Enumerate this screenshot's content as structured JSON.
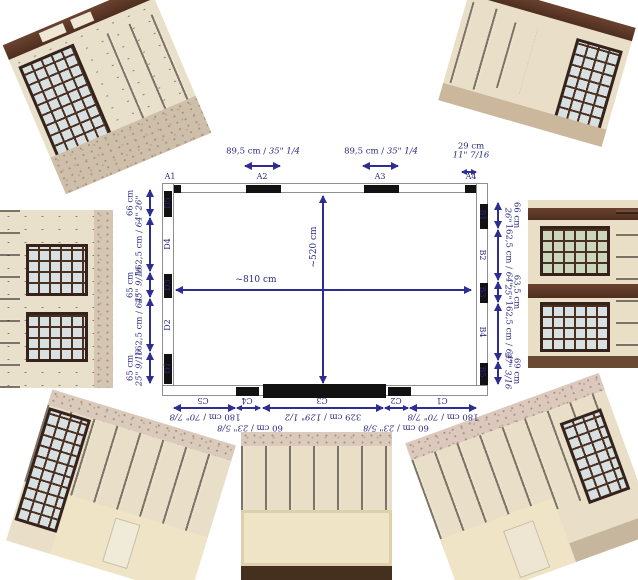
{
  "colors": {
    "annotation_navy": "#2d2d92",
    "wall_black": "#121212",
    "wall_outline_gray": "#8f8f8f",
    "wood_brown": "#5d3a28",
    "cream_wall": "#e9dfc8"
  },
  "plan": {
    "overall": {
      "width_label": "~810 cm",
      "height_label": "~520 cm"
    },
    "top_wall": {
      "labels": [
        "A1",
        "A2",
        "A3",
        "A4"
      ],
      "measures": [
        {
          "cm": "89,5 cm",
          "sep": " / ",
          "in": "35\" 1/4"
        },
        {
          "cm": "89,5 cm",
          "sep": " / ",
          "in": "35\" 1/4"
        },
        {
          "cm": "29 cm",
          "in": "11\" 7/16"
        }
      ]
    },
    "left_wall": {
      "labels": [
        "D5",
        "D4",
        "D3",
        "D2",
        "D1"
      ],
      "measures": [
        {
          "cm": "66 cm",
          "in": "26\""
        },
        {
          "cm": "162,5 cm",
          "sep": " / ",
          "in": "64\""
        },
        {
          "cm": "65 cm",
          "in": "25\" 9/16"
        },
        {
          "cm": "162,5 cm",
          "sep": " / ",
          "in": "64\""
        },
        {
          "cm": "65 cm",
          "in": "25\" 9/16"
        }
      ]
    },
    "right_wall": {
      "labels": [
        "B1",
        "B2",
        "B3",
        "B4",
        "B5"
      ],
      "measures": [
        {
          "cm": "66 cm",
          "in": "26\""
        },
        {
          "cm": "162,5 cm",
          "sep": " / ",
          "in": "64\""
        },
        {
          "cm": "63,5 cm",
          "in": "25\""
        },
        {
          "cm": "162,5 cm",
          "sep": " / ",
          "in": "64\""
        },
        {
          "cm": "69 cm",
          "in": "27\" 3/16"
        }
      ]
    },
    "bottom_wall": {
      "labels": [
        "C5",
        "C4",
        "C3",
        "C2",
        "C1"
      ],
      "measures": [
        {
          "cm": "180 cm",
          "sep": " / ",
          "in": "70\" 7/8"
        },
        {
          "cm": "60 cm",
          "sep": " / ",
          "in": "23\" 5/8"
        },
        {
          "cm": "329 cm",
          "sep": " / ",
          "in": "129\" 1/2"
        },
        {
          "cm": "60 cm",
          "sep": " / ",
          "in": "23\" 5/8"
        },
        {
          "cm": "180 cm",
          "sep": " / ",
          "in": "70\" 7/8"
        }
      ]
    }
  },
  "photos": [
    {
      "id": "photo-top-left",
      "content": "tilted photo: room corner, tall window, wood door, damaged ceiling, debris"
    },
    {
      "id": "photo-top-right",
      "content": "tilted photo: room corner with doors, window and wood cornice"
    },
    {
      "id": "photo-mid-left",
      "content": "sideways photo: two windows with small panes and wood paneling"
    },
    {
      "id": "photo-mid-right",
      "content": "sideways photo: two windows with wood frames"
    },
    {
      "id": "photo-bottom-left",
      "content": "tilted photo: oak paneling corner with window and cream lower wall"
    },
    {
      "id": "photo-bottom-center",
      "content": "photo: row of oak wall panels above cream recessed wall"
    },
    {
      "id": "photo-bottom-right",
      "content": "tilted photo: oak paneling corner with window and radiator"
    }
  ]
}
